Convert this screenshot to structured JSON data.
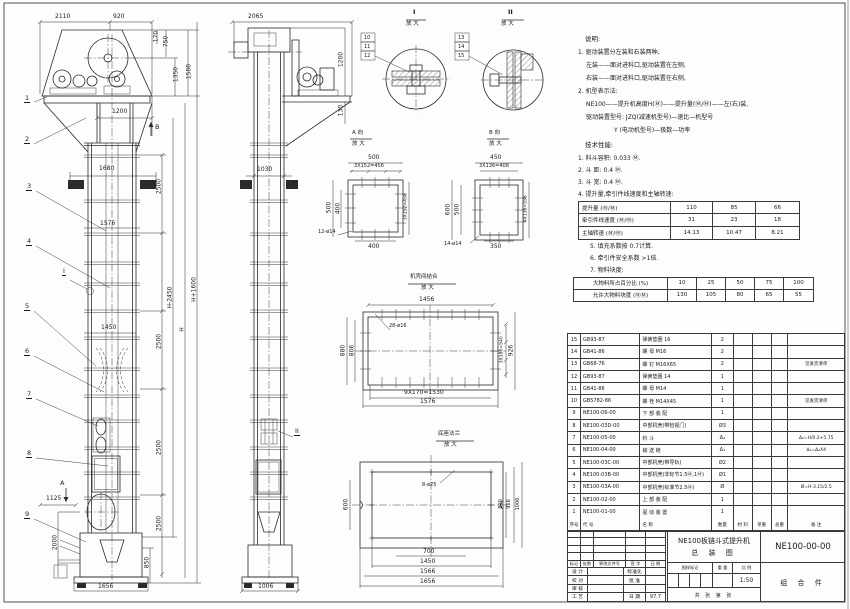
{
  "f": {
    "d2110": "2110",
    "d920": "920",
    "d170": "170",
    "d750": "750",
    "d1350": "1350",
    "d1500": "1500",
    "d1200": "1200",
    "d1680": "1680",
    "d2500a": "2500",
    "d1576": "1576",
    "d2500b": "2500",
    "d1450": "1450",
    "d2500c": "2500",
    "d2500d": "2500",
    "dHm": "H-2450",
    "dH": "H",
    "dHp": "H+1600",
    "d1125": "1125",
    "d2000": "2000",
    "d850": "850",
    "d1656": "1656",
    "mA": "A",
    "mB": "B",
    "mI": "I",
    "b1": "1",
    "b2": "2",
    "b3": "3",
    "b4": "4",
    "b5": "5",
    "b6": "6",
    "b7": "7",
    "b8": "8",
    "b9": "9"
  },
  "s": {
    "d2065": "2065",
    "d1200": "1200",
    "d130": "130",
    "d1030": "1030",
    "d1006": "1006",
    "mII": "II"
  },
  "di": {
    "t": "I",
    "sub": "放 大",
    "b10": "10",
    "b11": "11",
    "b12": "12"
  },
  "dii": {
    "t": "II",
    "sub": "放 大",
    "b13": "13",
    "b14": "14",
    "b15": "15"
  },
  "va": {
    "t": "A 向",
    "sub": "放 大",
    "top": "500",
    "top2": "3X152=456",
    "left": "500",
    "left2": "400",
    "right": "3X152=456",
    "bot": "400",
    "holes": "12-ø14"
  },
  "vb": {
    "t": "B 向",
    "sub": "放 大",
    "top": "450",
    "top2": "3X136=408",
    "left": "600",
    "left2": "500",
    "right": "4X139=556",
    "bot": "350",
    "holes": "14-ø14"
  },
  "jd": {
    "t": "机壳间结合",
    "sub": "放 大",
    "top": "1456",
    "holes": "28-ø16",
    "l1": "880",
    "l2": "806",
    "r1": "3X180=540",
    "r2": "926",
    "b1": "9X170=1530",
    "b2": "1576"
  },
  "bd": {
    "t": "底座法兰",
    "sub": "放 大",
    "holes": "8-ø25",
    "left": "600",
    "r1": "800",
    "r2": "916",
    "r3": "1006",
    "b1": "700",
    "b2": "1450",
    "b3": "1566",
    "b4": "1656"
  },
  "notes": {
    "h": "说明:",
    "l1": "1. 驱动装置分左装和右装两种,",
    "l2": "左装——面对进料口,驱动装置在左侧,",
    "l3": "右装——面对进料口,驱动装置在右侧,",
    "l4": "2. 机型表示法:",
    "l5": "NE100——提升机高度H(Ⓜ)——提升量(Ⓜ/Ⓜ)——左(右)装,",
    "l6": "驱动装置型号: JZQ(减速机型号)—速比—机型号",
    "l7": "Y (电动机型号)—极数—功率"
  },
  "spec": {
    "h": "技术性能:",
    "i1": "1. 料斗容积: 0.033 Ⓜ.",
    "i2": "2. 斗    距: 0.4 Ⓜ.",
    "i3": "3. 斗    宽: 0.4 Ⓜ.",
    "i4": "4. 提升量,牵引件线速度和主轴转速:",
    "n5": "5. 填充系数按 0.7计算.",
    "n6": "6. 牵引件安全系数 >1倍.",
    "n7": "7. 物料块度:"
  },
  "t1": {
    "rows": [
      [
        "提升量 (Ⓜ/Ⓜ)",
        "110",
        "85",
        "66"
      ],
      [
        "牵引件线速度 (Ⓜ/Ⓜ)",
        "31",
        "23",
        "18"
      ],
      [
        "主轴转速 (Ⓜ/Ⓜ)",
        "14.13",
        "10.47",
        "8.21"
      ]
    ]
  },
  "t2": {
    "rows": [
      [
        "大物料所占百分比 (%)",
        "10",
        "25",
        "50",
        "75",
        "100"
      ],
      [
        "允许大物料块度 (ⓂⓂ)",
        "130",
        "105",
        "80",
        "65",
        "55"
      ]
    ]
  },
  "bom": {
    "head": [
      "序号",
      "代  号",
      "名  称",
      "数量",
      "材 料",
      "单重",
      "总重",
      "备 注"
    ],
    "rows": [
      [
        "15",
        "GB93-87",
        "弹簧垫圈  16",
        "2",
        "",
        "",
        "",
        ""
      ],
      [
        "14",
        "GB41-86",
        "螺  母  M16",
        "2",
        "",
        "",
        "",
        ""
      ],
      [
        "13",
        "GB68-76",
        "螺  钉  M16X65",
        "2",
        "",
        "",
        "",
        "见发货清单"
      ],
      [
        "12",
        "GB93-87",
        "弹簧垫圈  14",
        "1",
        "",
        "",
        "",
        ""
      ],
      [
        "11",
        "GB41-86",
        "螺  母  M14",
        "1",
        "",
        "",
        "",
        ""
      ],
      [
        "10",
        "GB5782-86",
        "螺  栓  M14X45",
        "1",
        "",
        "",
        "",
        "见发货清单"
      ],
      [
        "9",
        "NE100-06-00",
        "下 部 装 配",
        "1",
        "",
        "",
        "",
        ""
      ],
      [
        "8",
        "NE100-03D-00",
        "中部机壳(带检视门)",
        "Ø3",
        "",
        "",
        "",
        ""
      ],
      [
        "7",
        "NE100-05-00",
        "料  斗",
        "Δ₂",
        "",
        "",
        "",
        "Δ₂=H/0.2+5.75"
      ],
      [
        "6",
        "NE100-04-00",
        "输 送 链",
        "Δ₁",
        "",
        "",
        "",
        "Δ₁=Δ₂X4"
      ],
      [
        "5",
        "NE100-03C-00",
        "中部机壳(带导轨)",
        "Ø2",
        "",
        "",
        "",
        ""
      ],
      [
        "4",
        "NE100-03B-00",
        "中部机壳(非标节1.5Ⓜ,1Ⓜ)",
        "Ø1",
        "",
        "",
        "",
        ""
      ],
      [
        "3",
        "NE100-03A-00",
        "中部机壳(标准节2.5Ⓜ)",
        "Ø",
        "",
        "",
        "",
        "Ø=H-3.15/2.5"
      ],
      [
        "2",
        "NE100-02-00",
        "上 部 装 配",
        "1",
        "",
        "",
        "",
        ""
      ],
      [
        "1",
        "NE100-01-00",
        "驱 动 装 置",
        "1",
        "",
        "",
        "",
        ""
      ]
    ]
  },
  "tb": {
    "c1": "标记",
    "c2": "处数",
    "c3": "更改文件号",
    "c4": "签 字",
    "c5": "日 期",
    "rows": [
      [
        "设 计",
        "",
        "标准化",
        ""
      ],
      [
        "校 对",
        "",
        "批 准",
        ""
      ],
      [
        "审 核",
        "",
        "",
        ""
      ],
      [
        "工 艺",
        "",
        "日 期",
        "97.7"
      ]
    ],
    "title1": "NE100板链斗式提升机",
    "title2": "总  装  图",
    "no": "NE100-00-00",
    "type": "组 合 件",
    "s1": "图样标记",
    "s2": "重 量",
    "s3": "比 例",
    "scale": "1:50",
    "sheets": "共  张  第  张"
  }
}
